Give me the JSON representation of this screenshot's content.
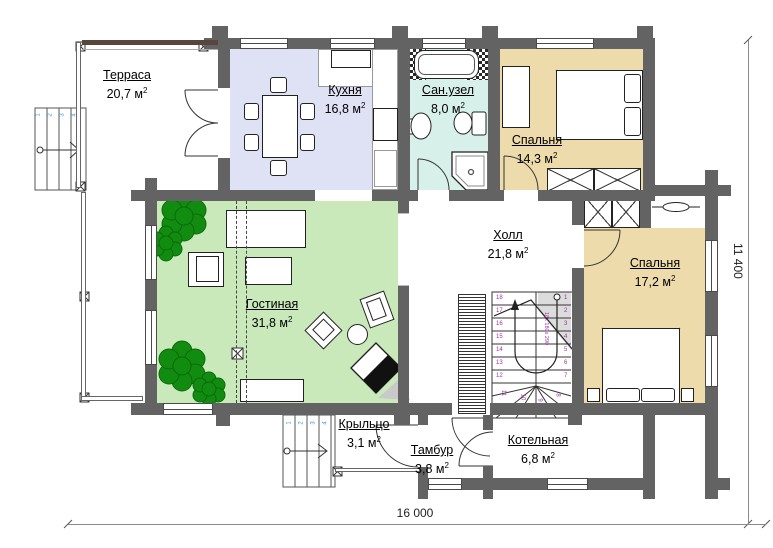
{
  "rooms": {
    "terrace": {
      "name": "Терраса",
      "area": "20,7 м"
    },
    "kitchen": {
      "name": "Кухня",
      "area": "16,8 м"
    },
    "bathroom": {
      "name": "Сан.узел",
      "area": "8,0 м"
    },
    "bedroom1": {
      "name": "Спальня",
      "area": "14,3 м"
    },
    "hall": {
      "name": "Холл",
      "area": "21,8 м"
    },
    "living": {
      "name": "Гостиная",
      "area": "31,8 м"
    },
    "bedroom2": {
      "name": "Спальня",
      "area": "17,2 м"
    },
    "porch": {
      "name": "Крыльцо",
      "area": "3,1 м"
    },
    "vestibule": {
      "name": "Тамбур",
      "area": "3,8 м"
    },
    "boiler": {
      "name": "Котельная",
      "area": "6,8 м"
    }
  },
  "units": {
    "sup": "2"
  },
  "dimensions": {
    "width": "16 000",
    "height": "11 400"
  },
  "stairs": {
    "annotation": "18x 180x 290",
    "left_numbers": [
      "18",
      "17",
      "16",
      "15",
      "14",
      "13",
      "12"
    ],
    "bottom_numbers": [
      "11",
      "10",
      "9",
      "8"
    ],
    "right_numbers": [
      "1",
      "2",
      "3",
      "4",
      "5",
      "6",
      "7"
    ],
    "terrace_steps": [
      "1",
      "2",
      "3",
      "4"
    ],
    "porch_steps": [
      "1",
      "2",
      "3",
      "4"
    ]
  },
  "colors": {
    "wall": "#636363",
    "kitchen": "#dfe1f5",
    "bathroom": "#d7f1ea",
    "bedroom": "#eedbab",
    "living": "#c9e9ba",
    "plant": "#118c11",
    "stair_numbers": "#a332a3",
    "step_numbers": "#3d9bd1"
  }
}
